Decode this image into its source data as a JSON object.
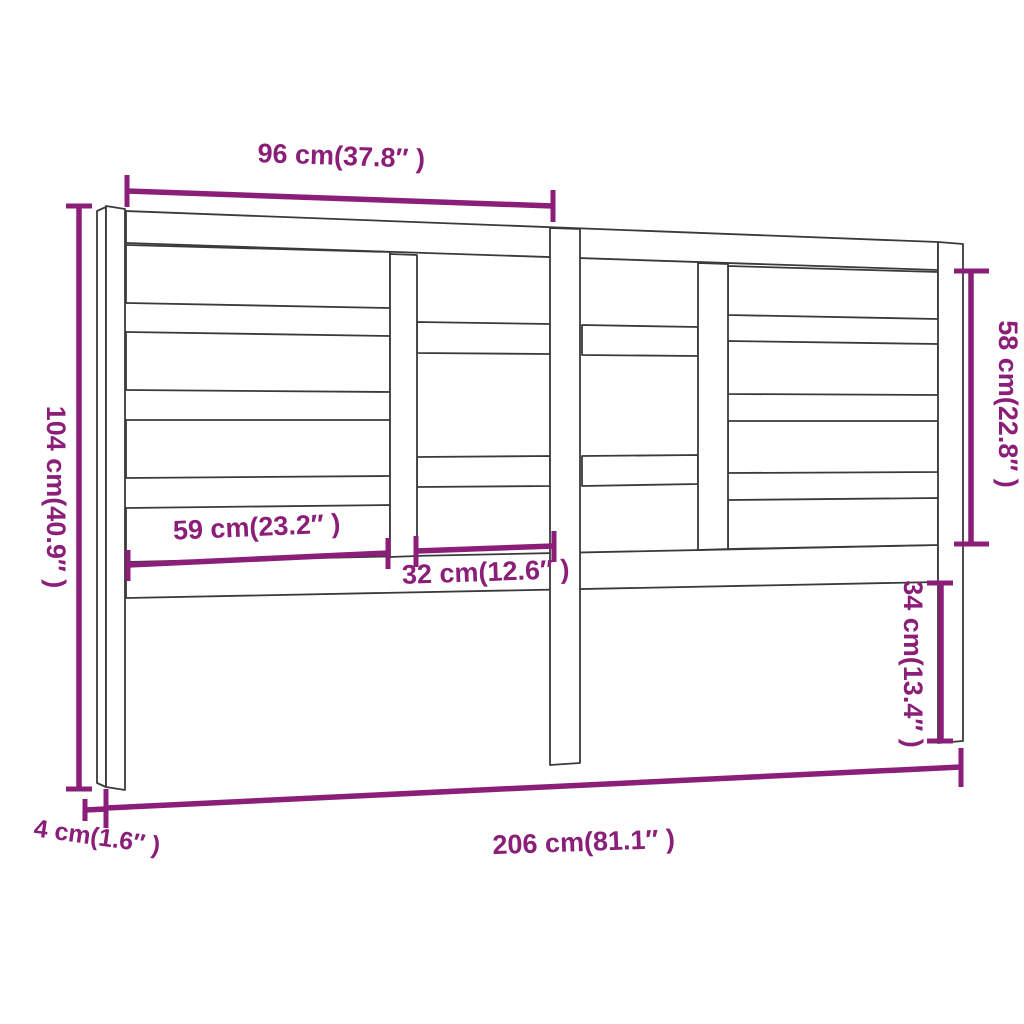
{
  "diagram": {
    "type": "furniture-dimension-diagram",
    "subject": "bed-headboard",
    "colors": {
      "dimension": "#8a1e78",
      "outline": "#3a3a3a",
      "wood_fill": "#ffffff",
      "background": "#ffffff"
    },
    "dimensions": {
      "top_width": "96 cm(37.8″ )",
      "left_height": "104 cm(40.9″ )",
      "right_upper_height": "58 cm(22.8″ )",
      "left_panel_width": "59 cm(23.2″ )",
      "center_panel_width": "32 cm(12.6″ )",
      "right_lower_height": "34 cm(13.4″ )",
      "bottom_width": "206 cm(81.1″ )",
      "post_thickness": "4 cm(1.6″ )"
    }
  }
}
